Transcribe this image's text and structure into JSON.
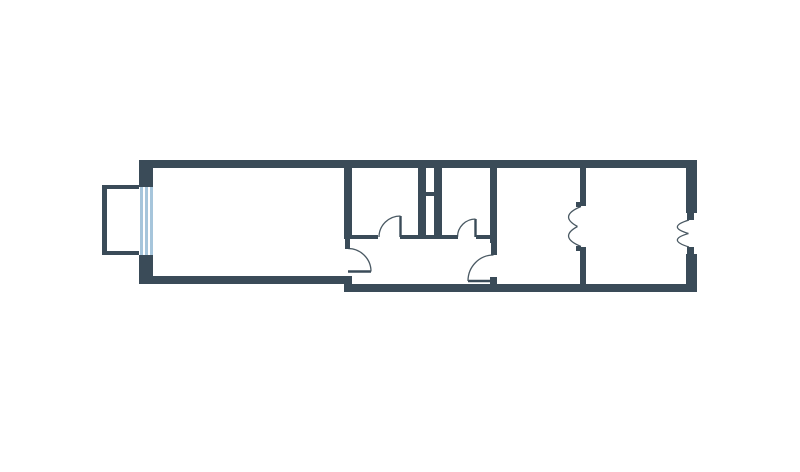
{
  "meta": {
    "description": "Architectural floor plan of a narrow apartment, rendered as dark walls on a white background. No text labels are visible in the image.",
    "canvas": {
      "width": 800,
      "height": 472,
      "background": "#ffffff"
    }
  },
  "palette": {
    "wall": "#3A4B58",
    "door_stroke": "#4A5963",
    "window_frame": "#A6C5DB",
    "window_bg": "#ffffff",
    "floor": "#ffffff"
  },
  "floorplan": {
    "walls": [
      {
        "name": "outer-wall-top",
        "x": 139,
        "y": 160,
        "w": 558,
        "h": 8
      },
      {
        "name": "outer-wall-left-above-window",
        "x": 139,
        "y": 168,
        "w": 14,
        "h": 19
      },
      {
        "name": "outer-wall-left-below-window",
        "x": 139,
        "y": 255,
        "w": 14,
        "h": 21
      },
      {
        "name": "outer-wall-bottom-left",
        "x": 139,
        "y": 276,
        "w": 213,
        "h": 8
      },
      {
        "name": "outer-wall-bottom-right",
        "x": 344,
        "y": 284,
        "w": 353,
        "h": 8
      },
      {
        "name": "outer-wall-right-upper",
        "x": 686,
        "y": 160,
        "w": 11,
        "h": 53
      },
      {
        "name": "entry-door-jamb-top",
        "x": 687,
        "y": 213,
        "w": 7,
        "h": 7
      },
      {
        "name": "entry-door-jamb-bottom",
        "x": 687,
        "y": 247,
        "w": 7,
        "h": 7
      },
      {
        "name": "outer-wall-right-lower",
        "x": 686,
        "y": 254,
        "w": 11,
        "h": 38
      },
      {
        "name": "partition-living-room",
        "x": 344,
        "y": 168,
        "w": 8,
        "h": 71
      },
      {
        "name": "partition-living-room-jamb",
        "x": 345,
        "y": 239,
        "w": 5,
        "h": 10
      },
      {
        "name": "shaft-wall-left",
        "x": 418,
        "y": 168,
        "w": 8,
        "h": 70
      },
      {
        "name": "shaft-wall-right",
        "x": 434,
        "y": 168,
        "w": 8,
        "h": 70
      },
      {
        "name": "shaft-divider",
        "x": 426,
        "y": 192,
        "w": 8,
        "h": 4
      },
      {
        "name": "partition-corridor-upper",
        "x": 490,
        "y": 168,
        "w": 7,
        "h": 75
      },
      {
        "name": "partition-corridor-jamb",
        "x": 491,
        "y": 243,
        "w": 6,
        "h": 12
      },
      {
        "name": "partition-corridor-hinge-nub",
        "x": 490,
        "y": 277,
        "w": 7,
        "h": 7
      },
      {
        "name": "partition-rooms-upper",
        "x": 580,
        "y": 168,
        "w": 6,
        "h": 38
      },
      {
        "name": "double-door-nub-top",
        "x": 576,
        "y": 202,
        "w": 5,
        "h": 5
      },
      {
        "name": "partition-rooms-lower",
        "x": 580,
        "y": 247,
        "w": 6,
        "h": 37
      },
      {
        "name": "double-door-nub-bottom",
        "x": 576,
        "y": 246,
        "w": 5,
        "h": 5
      },
      {
        "name": "corridor-wall-segment-a",
        "x": 352,
        "y": 235,
        "w": 26,
        "h": 4
      },
      {
        "name": "corridor-wall-segment-b",
        "x": 400,
        "y": 235,
        "w": 58,
        "h": 4
      },
      {
        "name": "corridor-wall-segment-c",
        "x": 476,
        "y": 235,
        "w": 14,
        "h": 4
      },
      {
        "name": "balcony-wall-left",
        "x": 102,
        "y": 185,
        "w": 5,
        "h": 70
      },
      {
        "name": "balcony-wall-top",
        "x": 102,
        "y": 185,
        "w": 38,
        "h": 4
      },
      {
        "name": "balcony-wall-bottom",
        "x": 102,
        "y": 251,
        "w": 38,
        "h": 4
      }
    ],
    "window": {
      "name": "balcony-window",
      "x": 139,
      "y": 187,
      "w": 14,
      "h": 68,
      "stripe_offsets": [
        0.5,
        5.5,
        11
      ],
      "stripe_width": 3
    },
    "doors": {
      "leaves": [
        {
          "name": "door-leaf-small-room-left",
          "x1": 400.5,
          "y1": 237,
          "x2": 400.5,
          "y2": 216
        },
        {
          "name": "door-leaf-small-room-right",
          "x1": 475.5,
          "y1": 237,
          "x2": 475.5,
          "y2": 219
        },
        {
          "name": "door-leaf-living-room",
          "x1": 348,
          "y1": 271.5,
          "x2": 371,
          "y2": 271.5
        },
        {
          "name": "door-leaf-center-room",
          "x1": 493.5,
          "y1": 281,
          "x2": 468,
          "y2": 281
        }
      ],
      "arcs": [
        {
          "name": "door-arc-small-room-left",
          "d": "M 400.5,216 A 21.5,21 0 0 0 379,237"
        },
        {
          "name": "door-arc-small-room-right",
          "d": "M 475.5,219 A 18,18 0 0 0 457.5,237"
        },
        {
          "name": "door-arc-living-room",
          "d": "M 371,271.5 A 23,23 0 0 0 348,248.5"
        },
        {
          "name": "door-arc-center-room",
          "d": "M 468,281 A 25.5,26 0 0 1 493.5,255"
        },
        {
          "name": "double-door-arc-rooms-top",
          "d": "M 581,206.5 Q 558,216 577.5,226.5"
        },
        {
          "name": "double-door-arc-rooms-bottom",
          "d": "M 581,246.5 Q 558,237 577.5,226.5"
        },
        {
          "name": "double-door-arc-entry-top",
          "d": "M 689,220 Q 666,227 688.5,233.5"
        },
        {
          "name": "double-door-arc-entry-bottom",
          "d": "M 689,247 Q 666,240 688.5,233.5"
        }
      ]
    },
    "rooms": [
      {
        "name": "balcony",
        "x": 107,
        "y": 189,
        "w": 32,
        "h": 62
      },
      {
        "name": "living-room",
        "x": 153,
        "y": 168,
        "w": 191,
        "h": 108
      },
      {
        "name": "small-room-left",
        "x": 352,
        "y": 168,
        "w": 66,
        "h": 67
      },
      {
        "name": "small-room-right",
        "x": 442,
        "y": 168,
        "w": 48,
        "h": 67
      },
      {
        "name": "corridor",
        "x": 352,
        "y": 239,
        "w": 138,
        "h": 45
      },
      {
        "name": "center-room",
        "x": 497,
        "y": 168,
        "w": 83,
        "h": 116
      },
      {
        "name": "right-room",
        "x": 586,
        "y": 168,
        "w": 100,
        "h": 116
      }
    ]
  }
}
